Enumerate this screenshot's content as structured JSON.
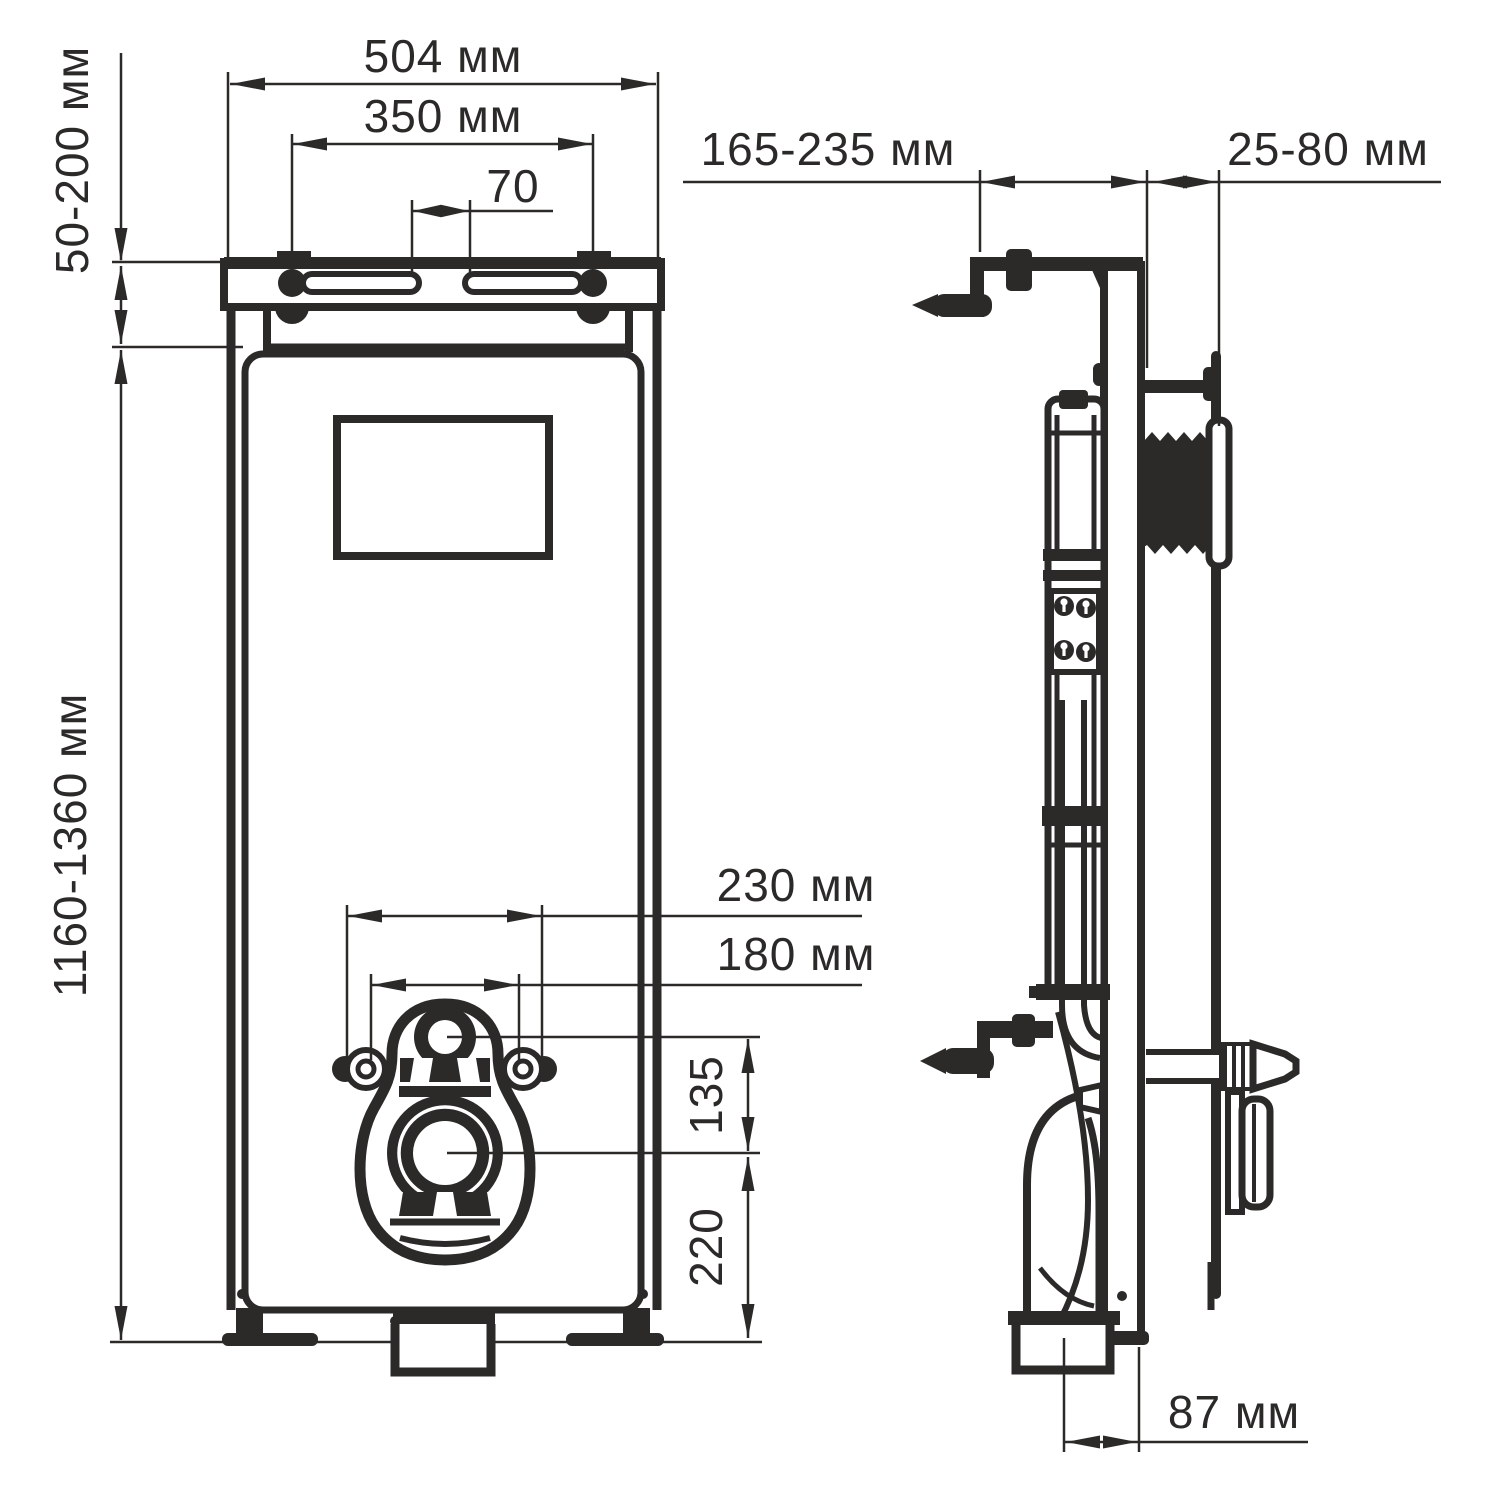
{
  "drawing": {
    "type": "installation-frame-technical-drawing",
    "line_color": "#2b2a29",
    "background_color": "#ffffff",
    "front": {
      "dims": {
        "width": "504 мм",
        "bolts": "350 мм",
        "slots": "70",
        "top_adjust": "50-200 мм",
        "height": "1160-1360 мм",
        "holes_outer": "230 мм",
        "holes_inner": "180 мм",
        "pipe_to_drain": "135",
        "drain_to_floor": "220"
      }
    },
    "side": {
      "dims": {
        "depth": "165-235 мм",
        "wall_offset": "25-80 мм",
        "drain_offset": "87 мм"
      }
    }
  }
}
